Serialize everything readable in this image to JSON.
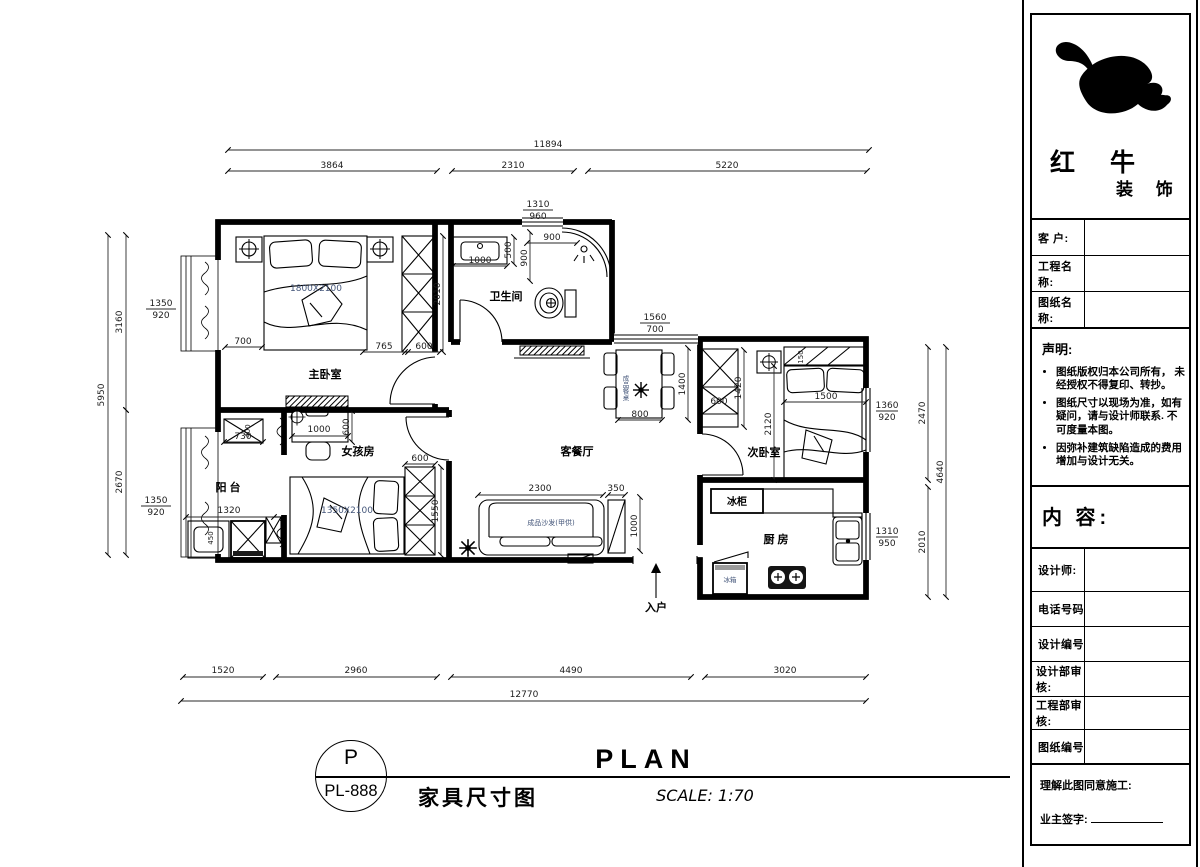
{
  "plan": {
    "rooms": {
      "master_bedroom": "主卧室",
      "bathroom": "卫生间",
      "girls_room": "女孩房",
      "balcony": "阳 台",
      "living_dining": "客餐厅",
      "second_bedroom": "次卧室",
      "kitchen": "厨 房"
    },
    "appliances": {
      "freezer": "冰柜",
      "fridge": "冰箱"
    },
    "furniture": {
      "master_bed_size": "1800X2100",
      "girl_bed_size": "1350X2100",
      "sofa_label": "成品沙发(甲供)",
      "dining_table_label": "成品餐桌"
    },
    "entrance_label": "入户",
    "dims": {
      "top_total": "11894",
      "top_1": "3864",
      "top_2": "2310",
      "top_3": "5220",
      "bottom_1": "1520",
      "bottom_2": "2960",
      "bottom_3": "4490",
      "bottom_4": "3020",
      "bottom_total": "12770",
      "left_total": "5950",
      "left_1": "3160",
      "left_2": "2670",
      "right_1": "2470",
      "right_2": "2010",
      "right_total": "4640",
      "win_bath_w": "1310",
      "win_bath_h": "960",
      "win_living_w": "1560",
      "win_living_h": "700",
      "win_bed2_w": "1360",
      "win_bed2_h": "920",
      "win_kitchen_w": "1310",
      "win_kitchen_h": "950",
      "win_bay1_w": "1350",
      "win_bay1_h": "920",
      "win_bay2_w": "1350",
      "win_bay2_h": "920",
      "mb_700": "700",
      "mb_765": "765",
      "mb_600": "600",
      "mb_2010": "2010",
      "bath_500": "500",
      "bath_1000": "1000",
      "bath_900a": "900",
      "bath_900b": "900",
      "girl_1000": "1000",
      "girl_600_desk": "600",
      "girl_600_ward": "600",
      "girl_1550": "1550",
      "bal_730": "730",
      "bal_400": "400",
      "bal_1320": "1320",
      "bal_450": "450",
      "lv_2300": "2300",
      "lv_350": "350",
      "lv_1000": "1000",
      "lv_800": "800",
      "lv_1400": "1400",
      "b2_600": "600",
      "b2_1420": "1420",
      "b2_150": "150",
      "b2_1500": "1500",
      "b2_2120": "2120"
    }
  },
  "sheet": {
    "logo_line1": "红 牛",
    "logo_line2": "装 饰",
    "fields_top": [
      {
        "label": "客  户:"
      },
      {
        "label": "工程名称:"
      },
      {
        "label": "图纸名称:"
      }
    ],
    "statement_heading": "声明:",
    "statement_items": [
      {
        "lines": "图纸版权归本公司所有， 未经授权不得复印、转抄。"
      },
      {
        "lines": "图纸尺寸以现场为准，如有 疑问，请与设计师联系. 不可度量本图。"
      },
      {
        "lines": "因弥补建筑缺陷造成的费用 增加与设计无关。"
      }
    ],
    "content_label": "内 容:",
    "fields_bottom": [
      {
        "label": "设计师:"
      },
      {
        "label": "电话号码"
      },
      {
        "label": "设计编号"
      },
      {
        "label": "设计部审核:"
      },
      {
        "label": "工程部审核:"
      },
      {
        "label": "图纸编号"
      }
    ],
    "footer_line1": "理解此图同意施工:",
    "footer_line2": "业主签字:"
  },
  "titlebar": {
    "circle_top": "P",
    "circle_bottom": "PL-888",
    "drawing_name": "家具尺寸图",
    "plan_word": "PLAN",
    "scale": "SCALE: 1:70"
  },
  "colors": {
    "line": "#000000",
    "accent_text": "#44567a"
  }
}
